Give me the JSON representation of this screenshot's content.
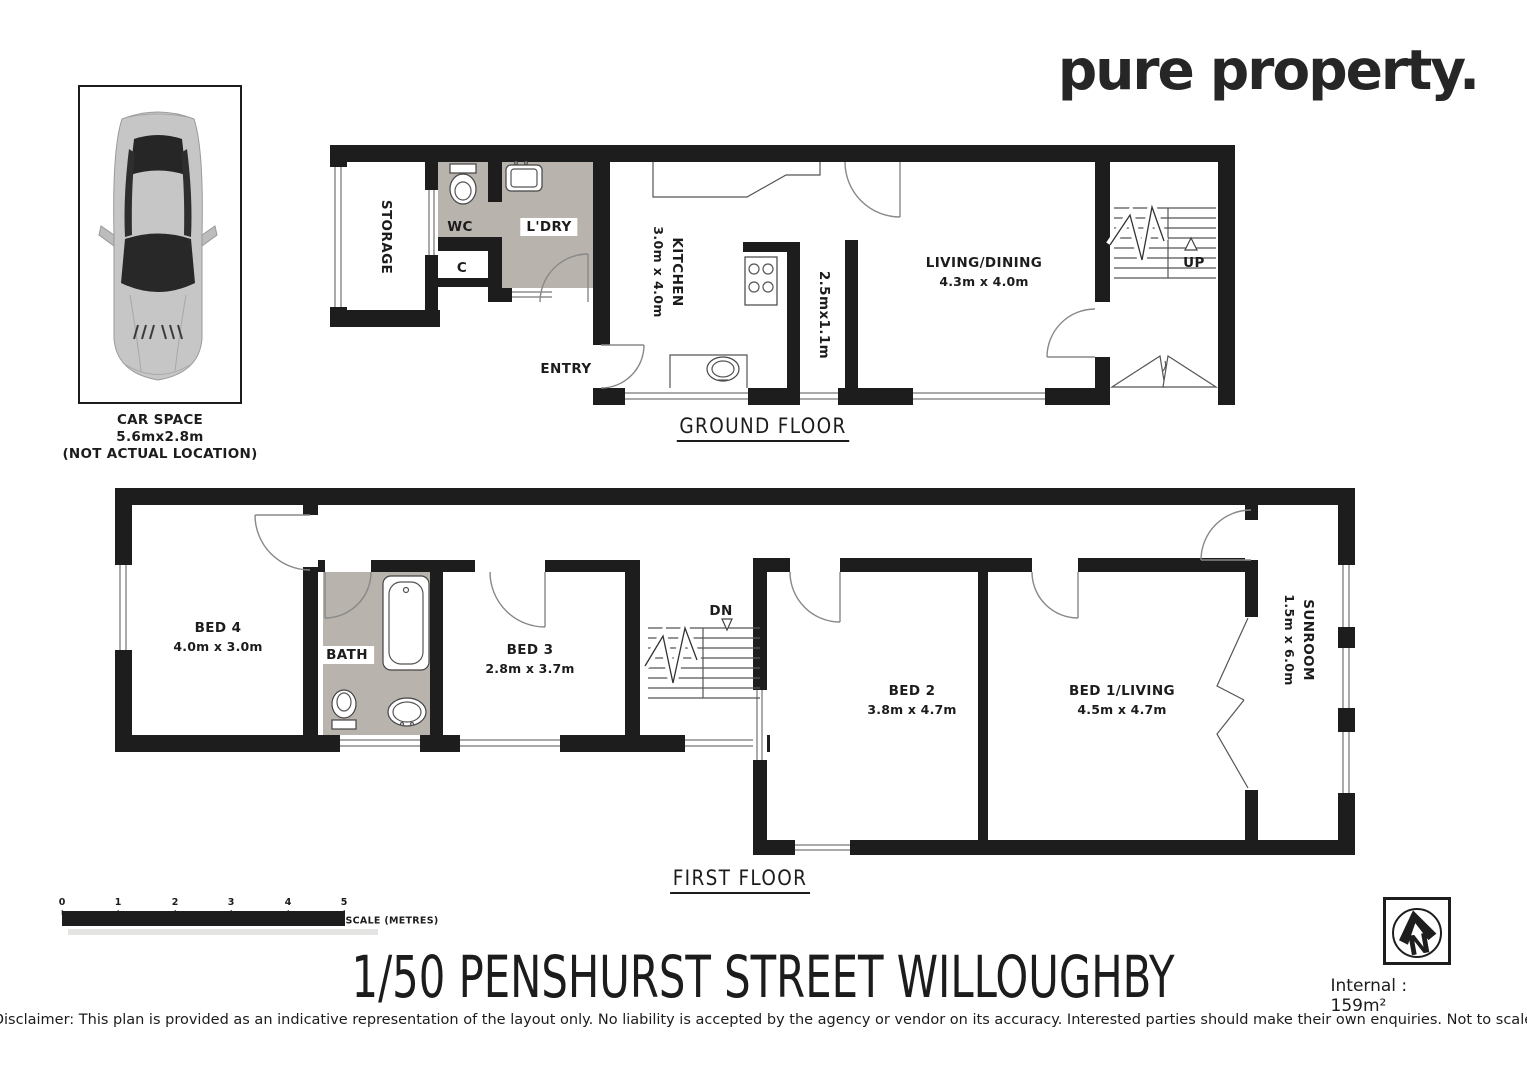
{
  "brand": {
    "logo": "pure property."
  },
  "car_space": {
    "title": "CAR SPACE",
    "size": "5.6mx2.8m",
    "note": "(NOT ACTUAL LOCATION)"
  },
  "ground_floor": {
    "label": "GROUND FLOOR",
    "storage": "STORAGE",
    "wc": "WC",
    "closet": "C",
    "laundry": "L'DRY",
    "kitchen_name": "KITCHEN",
    "kitchen_dims": "3.0m x 4.0m",
    "hall_dims": "2.5mx1.1m",
    "living_name": "LIVING/DINING",
    "living_dims": "4.3m x 4.0m",
    "entry": "ENTRY",
    "up": "UP"
  },
  "first_floor": {
    "label": "FIRST FLOOR",
    "bed4_name": "BED 4",
    "bed4_dims": "4.0m x 3.0m",
    "bath": "BATH",
    "bed3_name": "BED 3",
    "bed3_dims": "2.8m x 3.7m",
    "dn": "DN",
    "bed2_name": "BED 2",
    "bed2_dims": "3.8m x 4.7m",
    "bed1_name": "BED 1/LIVING",
    "bed1_dims": "4.5m x 4.7m",
    "sunroom_name": "SUNROOM",
    "sunroom_dims": "1.5m x 6.0m"
  },
  "scale_bar": {
    "ticks": [
      "0",
      "1",
      "2",
      "3",
      "4",
      "5"
    ],
    "label": "SCALE (METRES)"
  },
  "address_title": "1/50 PENSHURST STREET WILLOUGHBY",
  "compass": {
    "letter": "N"
  },
  "internal_area": "Internal : 159m²",
  "disclaimer": "Disclaimer: This plan is provided as an indicative representation of the layout only. No liability is accepted by the agency or vendor on its accuracy. Interested parties should make their own enquiries. Not to scale",
  "colors": {
    "wall": "#1d1d1d",
    "wet_area": "#b8b4ad"
  }
}
